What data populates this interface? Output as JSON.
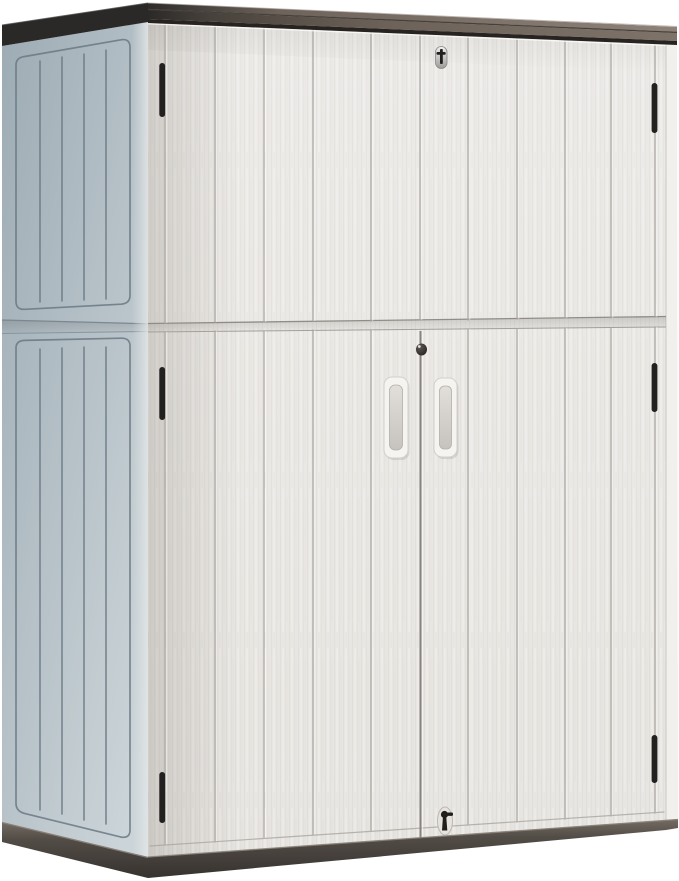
{
  "scene": {
    "description": "Product photo of a two-tier light gray resin outdoor storage cabinet with vertical wood-grain plank doors, dark charcoal-taupe lid, dark base, three key locks, six black hinges and two recessed door handles, shown in three-quarter front-left view on a white background",
    "object_name": "outdoor-storage-cabinet",
    "view": "three-quarter front-left",
    "feature_counts": {
      "tiers": 2,
      "hinges": 6,
      "keyholes": 3,
      "door_handles": 2,
      "front_planks": 10,
      "side_planks": 5
    }
  },
  "colors": {
    "background": "#ffffff",
    "front_face_top": "#edebe8",
    "front_face_bottom": "#e7e5e1",
    "plank_groove": "#a9a6a1",
    "groove_highlight": "#ffffff",
    "seam_line": "#908d88",
    "door_seam": "#87847f",
    "side_panel_dark": "#9dabb4",
    "side_panel_light": "#cbd4d8",
    "side_groove": "#6b7983",
    "lid_charcoal": "#2b2928",
    "lid_taupe": "#7e7369",
    "lid_taupe_light": "#8d8178",
    "lid_underline": "#262320",
    "base_dark": "#534d47",
    "base_light": "#746c64",
    "base_deep": "#36322e",
    "hinge_black": "#232120",
    "handle_face": "#f5f4f1",
    "handle_recess_top": "#e2dfda",
    "handle_recess_bottom": "#c6c3be",
    "lock_metal_light": "#efefee",
    "lock_metal_dark": "#9e9c99",
    "lock_black": "#211e1c",
    "return_strip": "#f1f0ed"
  }
}
